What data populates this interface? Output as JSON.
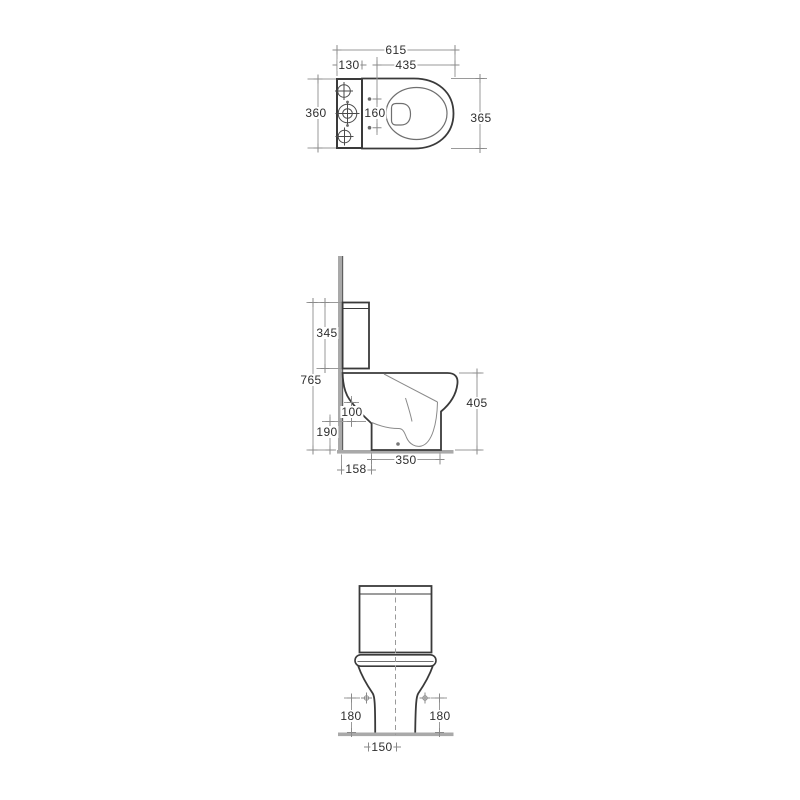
{
  "drawing": {
    "description": "Technical dimension drawing of a close-coupled toilet: plan view (top), side elevation (middle), front elevation (bottom)",
    "units": "mm",
    "colors": {
      "outline": "#3a3a3a",
      "thin_line": "#8a8a8a",
      "dimension_line": "#9a9a9a",
      "text": "#2e2e2e",
      "wall_fill": "#a9a9a9",
      "wall_edge": "#5f5f5f",
      "floor_fill": "#a9a9a9"
    },
    "plan": {
      "overall_length": "615",
      "cistern_depth": "130",
      "bowl_projection": "435",
      "cistern_width": "360",
      "seat_fixing_centres": "160",
      "bowl_width": "365"
    },
    "side": {
      "cistern_height": "345",
      "overall_height": "765",
      "rim_height": "405",
      "inlet_offset": "100",
      "outlet_height": "190",
      "base_length": "350",
      "wall_setout": "158"
    },
    "front": {
      "fixing_height_left": "180",
      "fixing_height_right": "180",
      "base_width": "150"
    }
  }
}
